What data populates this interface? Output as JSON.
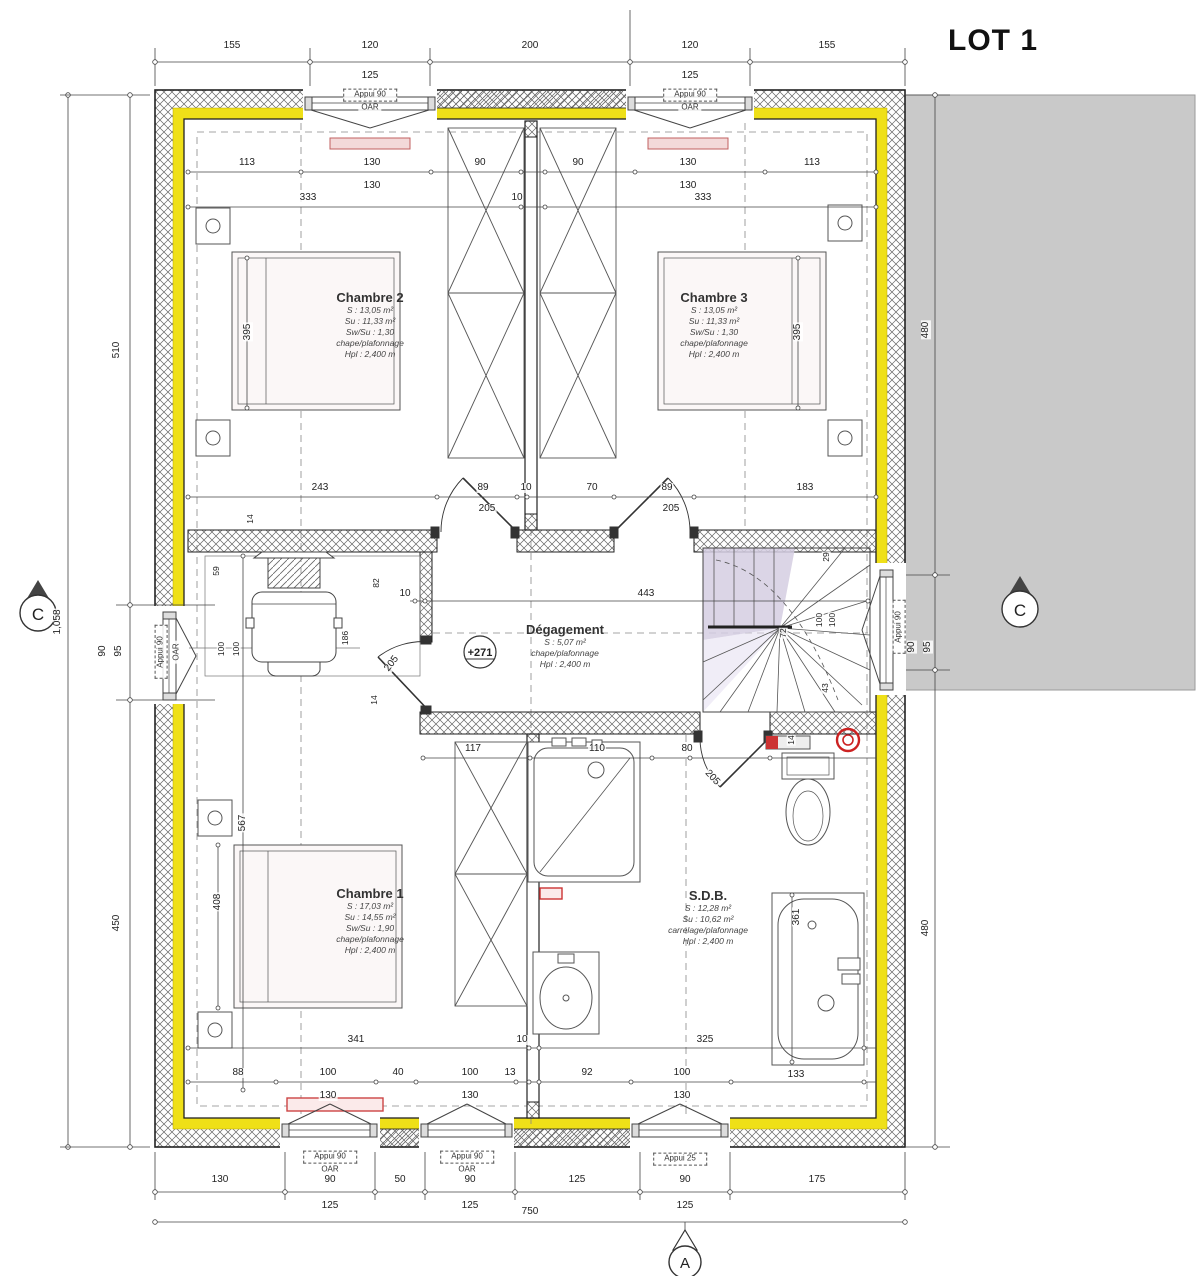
{
  "title": "LOT 1",
  "sections": {
    "left": "C",
    "right": "C",
    "bottom": "A"
  },
  "level_marker": "+271",
  "rooms": {
    "chambre2": {
      "name": "Chambre 2",
      "s": "S : 13,05 m²",
      "su": "Su : 11,33 m²",
      "svsu": "Sw/Su : 1,30",
      "finish": "chape/plafonnage",
      "hpl": "Hpl : 2,400 m"
    },
    "chambre3": {
      "name": "Chambre 3",
      "s": "S : 13,05 m²",
      "su": "Su : 11,33 m²",
      "svsu": "Sw/Su : 1,30",
      "finish": "chape/plafonnage",
      "hpl": "Hpl : 2,400 m"
    },
    "chambre1": {
      "name": "Chambre 1",
      "s": "S : 17,03 m²",
      "su": "Su : 14,55 m²",
      "svsu": "Sw/Su : 1,90",
      "finish": "chape/plafonnage",
      "hpl": "Hpl : 2,400 m"
    },
    "sdb": {
      "name": "S.D.B.",
      "s": "S : 12,28 m²",
      "su": "Su : 10,62 m²",
      "finish": "carrelage/plafonnage",
      "hpl": "Hpl : 2,400 m"
    },
    "degagement": {
      "name": "Dégagement",
      "s": "S : 5,07 m²",
      "finish": "chape/plafonnage",
      "hpl": "Hpl : 2,400 m"
    }
  },
  "colors": {
    "wall_yellow": "#efe018",
    "neighbour_gray": "#c9c9c9",
    "stair_lavender": "#d5cee2",
    "accent_red": "#cc2222",
    "radiator_pink": "#f3d9d9"
  },
  "dimension_labels": [
    {
      "t": "155",
      "x": 232,
      "y": 46
    },
    {
      "t": "120",
      "x": 370,
      "y": 46
    },
    {
      "t": "125",
      "x": 370,
      "y": 76
    },
    {
      "t": "200",
      "x": 530,
      "y": 46
    },
    {
      "t": "120",
      "x": 690,
      "y": 46
    },
    {
      "t": "125",
      "x": 690,
      "y": 76
    },
    {
      "t": "155",
      "x": 827,
      "y": 46
    },
    {
      "t": "130",
      "x": 220,
      "y": 1180
    },
    {
      "t": "90",
      "x": 330,
      "y": 1180
    },
    {
      "t": "125",
      "x": 330,
      "y": 1206
    },
    {
      "t": "50",
      "x": 400,
      "y": 1180
    },
    {
      "t": "90",
      "x": 470,
      "y": 1180
    },
    {
      "t": "125",
      "x": 470,
      "y": 1206
    },
    {
      "t": "125",
      "x": 577,
      "y": 1180
    },
    {
      "t": "90",
      "x": 685,
      "y": 1180
    },
    {
      "t": "125",
      "x": 685,
      "y": 1206
    },
    {
      "t": "175",
      "x": 817,
      "y": 1180
    },
    {
      "t": "750",
      "x": 530,
      "y": 1212
    },
    {
      "t": "510",
      "x": 117,
      "y": 350,
      "r": 1
    },
    {
      "t": "90",
      "x": 103,
      "y": 651,
      "r": 1
    },
    {
      "t": "95",
      "x": 119,
      "y": 651,
      "r": 1
    },
    {
      "t": "450",
      "x": 117,
      "y": 923,
      "r": 1
    },
    {
      "t": "1,058",
      "x": 58,
      "y": 622,
      "r": 1
    },
    {
      "t": "480",
      "x": 926,
      "y": 330,
      "r": 1
    },
    {
      "t": "90",
      "x": 912,
      "y": 647,
      "r": 1
    },
    {
      "t": "95",
      "x": 928,
      "y": 647,
      "r": 1
    },
    {
      "t": "480",
      "x": 926,
      "y": 928,
      "r": 1
    },
    {
      "t": "113",
      "x": 247,
      "y": 163
    },
    {
      "t": "130",
      "x": 372,
      "y": 163
    },
    {
      "t": "130",
      "x": 372,
      "y": 186
    },
    {
      "t": "90",
      "x": 480,
      "y": 163
    },
    {
      "t": "90",
      "x": 578,
      "y": 163
    },
    {
      "t": "130",
      "x": 688,
      "y": 163
    },
    {
      "t": "130",
      "x": 688,
      "y": 186
    },
    {
      "t": "113",
      "x": 812,
      "y": 163
    },
    {
      "t": "333",
      "x": 308,
      "y": 198
    },
    {
      "t": "10",
      "x": 517,
      "y": 198
    },
    {
      "t": "333",
      "x": 703,
      "y": 198
    },
    {
      "t": "395",
      "x": 248,
      "y": 332,
      "r": 1
    },
    {
      "t": "395",
      "x": 798,
      "y": 332,
      "r": 1
    },
    {
      "t": "567",
      "x": 243,
      "y": 823,
      "r": 1
    },
    {
      "t": "408",
      "x": 218,
      "y": 902,
      "r": 1
    },
    {
      "t": "361",
      "x": 797,
      "y": 917,
      "r": 1
    },
    {
      "t": "243",
      "x": 320,
      "y": 488
    },
    {
      "t": "89",
      "x": 483,
      "y": 488
    },
    {
      "t": "205",
      "x": 487,
      "y": 509
    },
    {
      "t": "10",
      "x": 526,
      "y": 488
    },
    {
      "t": "70",
      "x": 592,
      "y": 488
    },
    {
      "t": "89",
      "x": 667,
      "y": 488
    },
    {
      "t": "205",
      "x": 671,
      "y": 509
    },
    {
      "t": "183",
      "x": 805,
      "y": 488
    },
    {
      "t": "14",
      "x": 250,
      "y": 519,
      "r": 1,
      "s": 1
    },
    {
      "t": "59",
      "x": 216,
      "y": 571,
      "r": 1,
      "s": 1
    },
    {
      "t": "82",
      "x": 376,
      "y": 583,
      "r": 1,
      "s": 1
    },
    {
      "t": "186",
      "x": 345,
      "y": 638,
      "r": 1,
      "s": 1
    },
    {
      "t": "100",
      "x": 221,
      "y": 649,
      "r": 1,
      "s": 1
    },
    {
      "t": "100",
      "x": 236,
      "y": 649,
      "r": 1,
      "s": 1
    },
    {
      "t": "10",
      "x": 405,
      "y": 594
    },
    {
      "t": "443",
      "x": 646,
      "y": 594
    },
    {
      "t": "205",
      "x": 392,
      "y": 664,
      "r": 45
    },
    {
      "t": "14",
      "x": 374,
      "y": 700,
      "r": 1,
      "s": 1
    },
    {
      "t": "29",
      "x": 826,
      "y": 557,
      "r": 1,
      "s": 1
    },
    {
      "t": "100",
      "x": 819,
      "y": 620,
      "r": 1,
      "s": 1
    },
    {
      "t": "100",
      "x": 832,
      "y": 620,
      "r": 1,
      "s": 1
    },
    {
      "t": "72",
      "x": 783,
      "y": 633,
      "r": 1,
      "s": 1
    },
    {
      "t": "43",
      "x": 825,
      "y": 688,
      "r": 1,
      "s": 1
    },
    {
      "t": "117",
      "x": 473,
      "y": 749
    },
    {
      "t": "110",
      "x": 597,
      "y": 749
    },
    {
      "t": "80",
      "x": 687,
      "y": 749
    },
    {
      "t": "205",
      "x": 712,
      "y": 778,
      "r": -45
    },
    {
      "t": "14",
      "x": 791,
      "y": 740,
      "r": 1,
      "s": 1
    },
    {
      "t": "341",
      "x": 356,
      "y": 1040
    },
    {
      "t": "10",
      "x": 522,
      "y": 1040
    },
    {
      "t": "325",
      "x": 705,
      "y": 1040
    },
    {
      "t": "88",
      "x": 238,
      "y": 1073
    },
    {
      "t": "100",
      "x": 328,
      "y": 1073
    },
    {
      "t": "130",
      "x": 328,
      "y": 1096
    },
    {
      "t": "40",
      "x": 398,
      "y": 1073
    },
    {
      "t": "100",
      "x": 470,
      "y": 1073
    },
    {
      "t": "130",
      "x": 470,
      "y": 1096
    },
    {
      "t": "13",
      "x": 510,
      "y": 1073
    },
    {
      "t": "92",
      "x": 587,
      "y": 1073
    },
    {
      "t": "100",
      "x": 682,
      "y": 1073
    },
    {
      "t": "130",
      "x": 682,
      "y": 1096
    },
    {
      "t": "133",
      "x": 796,
      "y": 1075
    }
  ],
  "window_labels": [
    {
      "t": "Appui 90",
      "x": 370,
      "y": 95,
      "boxed": 1
    },
    {
      "t": "OAR",
      "x": 370,
      "y": 108
    },
    {
      "t": "Appui 90",
      "x": 690,
      "y": 95,
      "boxed": 1
    },
    {
      "t": "OAR",
      "x": 690,
      "y": 108
    },
    {
      "t": "Appui 90",
      "x": 330,
      "y": 1157,
      "boxed": 1
    },
    {
      "t": "OAR",
      "x": 330,
      "y": 1170
    },
    {
      "t": "Appui 90",
      "x": 467,
      "y": 1157,
      "boxed": 1
    },
    {
      "t": "OAR",
      "x": 467,
      "y": 1170
    },
    {
      "t": "Appui 25",
      "x": 680,
      "y": 1159,
      "boxed": 1
    },
    {
      "t": "Appui 90",
      "x": 161,
      "y": 652,
      "r": 1,
      "boxed": 1
    },
    {
      "t": "OAR",
      "x": 177,
      "y": 652,
      "r": 1
    },
    {
      "t": "Appui 90",
      "x": 899,
      "y": 627,
      "r": 1,
      "boxed": 1
    }
  ]
}
